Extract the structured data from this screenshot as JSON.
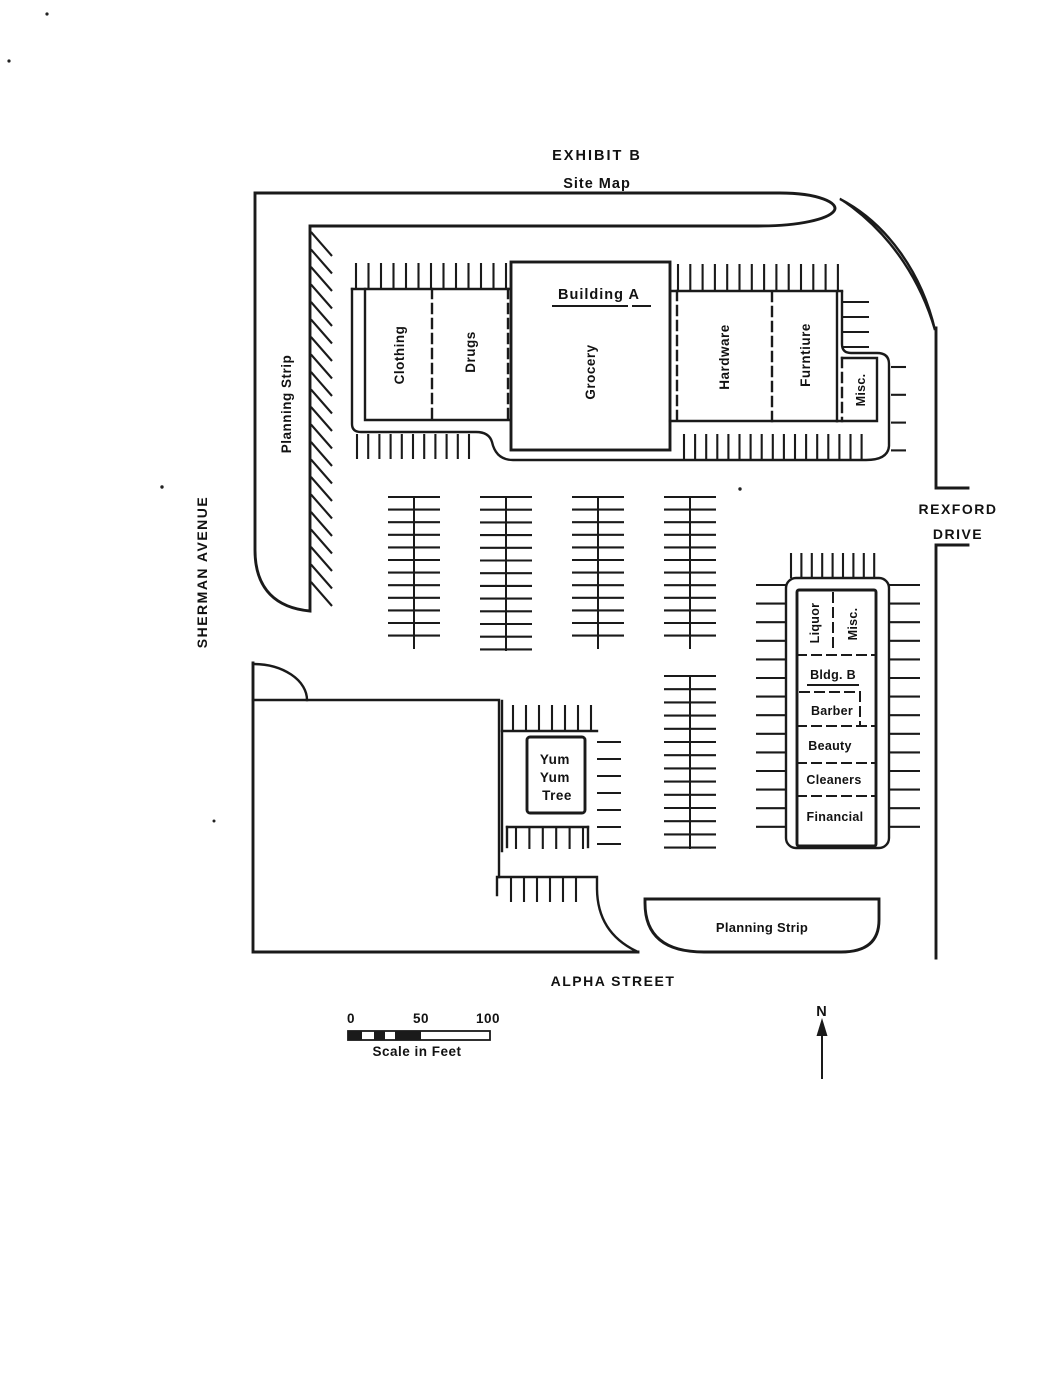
{
  "title": {
    "exhibit": "EXHIBIT B",
    "subtitle": "Site Map"
  },
  "streets": {
    "west": "SHERMAN AVENUE",
    "east": {
      "line1": "REXFORD",
      "line2": "DRIVE"
    },
    "south": "ALPHA STREET"
  },
  "planning_strip_west": "Planning Strip",
  "planning_strip_south": "Planning Strip",
  "building_a": {
    "title": "Building A",
    "units": {
      "clothing": "Clothing",
      "drugs": "Drugs",
      "grocery": "Grocery",
      "hardware": "Hardware",
      "furniture": "Furntiure",
      "misc": "Misc."
    }
  },
  "building_b": {
    "title": "Bldg. B",
    "units": {
      "liquor": "Liquor",
      "misc": "Misc.",
      "barber": "Barber",
      "beauty": "Beauty",
      "cleaners": "Cleaners",
      "financial": "Financial"
    }
  },
  "yum_yum_tree": {
    "line1": "Yum",
    "line2": "Yum",
    "line3": "Tree"
  },
  "scale_bar": {
    "tick0": "0",
    "tick50": "50",
    "tick100": "100",
    "caption": "Scale in Feet"
  },
  "compass": {
    "north": "N"
  }
}
